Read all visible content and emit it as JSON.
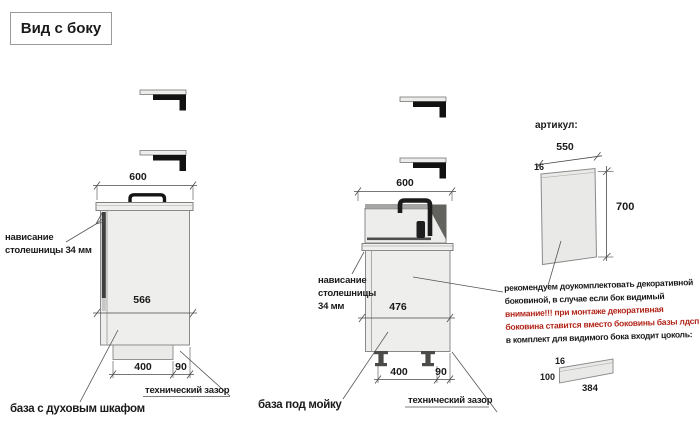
{
  "title": "Вид с боку",
  "colors": {
    "warning_red": "#b2261b",
    "cabinet_fill": "#ededeb",
    "line_gray": "#8a8a8a",
    "text_black": "#1a1a1a"
  },
  "icons": {
    "bracket": "L-shaped wall bracket",
    "oven_handle": "oven door handle",
    "faucet": "sink faucet",
    "foot": "adjustable cabinet foot"
  },
  "left_unit": {
    "label": "база с духовым шкафом",
    "dim_top_width": "600",
    "dim_body": "566",
    "dim_plinth": "400",
    "dim_gap": "90",
    "overhang_line1": "нависание",
    "overhang_line2": "столешницы 34 мм",
    "tech_gap_label": "технический зазор"
  },
  "middle_unit": {
    "label": "база под мойку",
    "dim_top_width": "600",
    "dim_body": "476",
    "dim_plinth": "400",
    "dim_gap": "90",
    "overhang_line1": "нависание",
    "overhang_line2": "столешницы",
    "overhang_line3": "34 мм",
    "tech_gap_label": "технический зазор"
  },
  "right_section": {
    "artikul_label": "артикул:",
    "side_panel": {
      "width": "550",
      "thickness": "16",
      "height": "700"
    },
    "note_line1": "рекомендуем доукомплектовать декоративной",
    "note_line2": "боковиной, в случае если бок видимый",
    "note_line3": "внимание!!! при монтаже декоративная",
    "note_line4": "боковина ставится вместо боковины базы лдсп",
    "note_line5": "в комплект для видимого бока входит цоколь:",
    "plinth_panel": {
      "height": "100",
      "thickness": "16",
      "length": "384"
    }
  }
}
